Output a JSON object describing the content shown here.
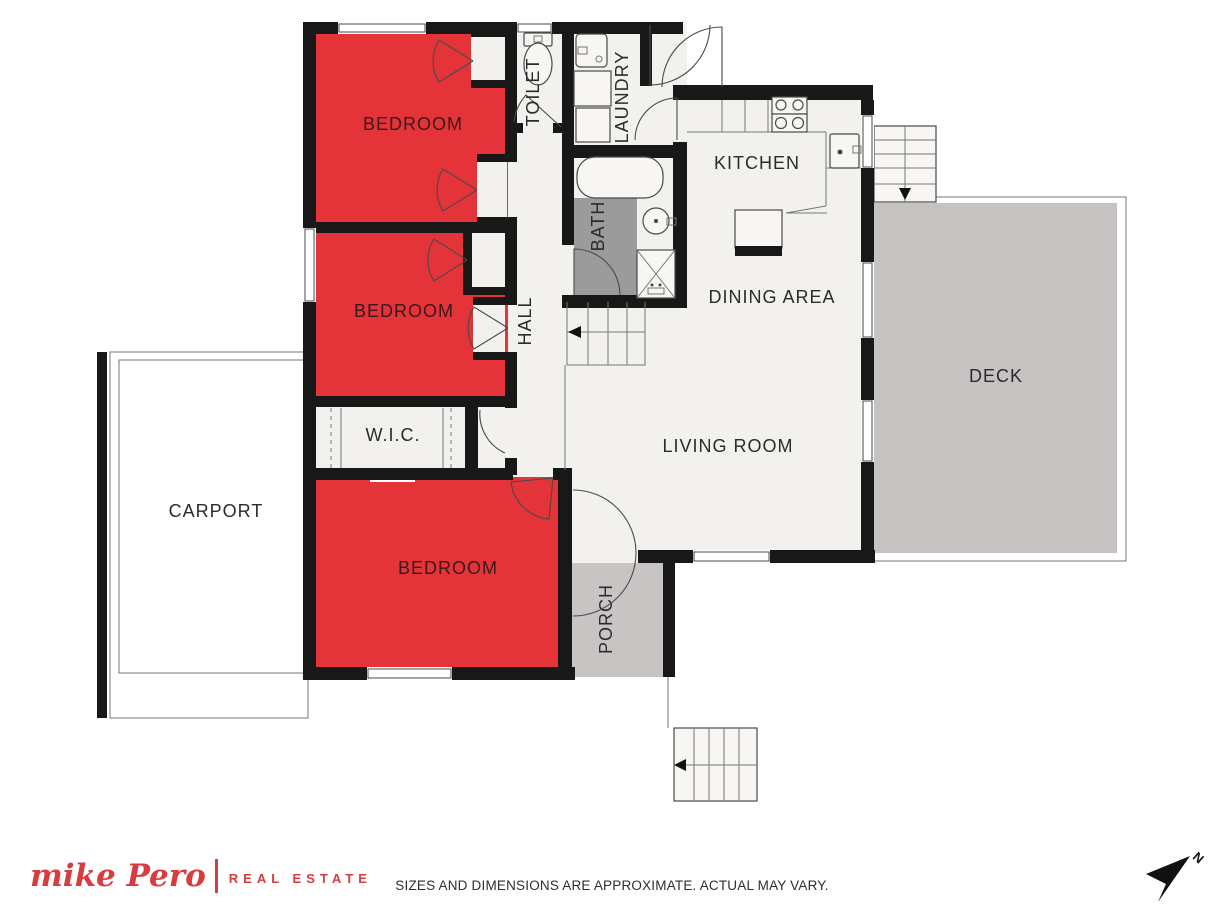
{
  "plan": {
    "rooms": {
      "bedroom1": "BEDROOM",
      "bedroom2": "BEDROOM",
      "bedroom3": "BEDROOM",
      "toilet": "TOILET",
      "laundry": "LAUNDRY",
      "bath": "BATH",
      "hall": "HALL",
      "kitchen": "KITCHEN",
      "dining": "DINING AREA",
      "living": "LIVING ROOM",
      "deck": "DECK",
      "wic": "W.I.C.",
      "carport": "CARPORT",
      "porch": "PORCH"
    },
    "colors": {
      "bedroom_fill": "#e5333a",
      "deck_fill": "#c6c2c1",
      "porch_fill": "#c8c4c3",
      "bath_floor_fill": "#9b9b9b",
      "wall": "#181818",
      "floor": "#f2f1ed"
    }
  },
  "footer": {
    "brand_script": "mike Pero",
    "brand_suffix": "REAL ESTATE",
    "brand_color": "#d93b3f",
    "disclaimer": "SIZES AND DIMENSIONS ARE APPROXIMATE. ACTUAL MAY VARY."
  },
  "compass": {
    "label": "N"
  }
}
